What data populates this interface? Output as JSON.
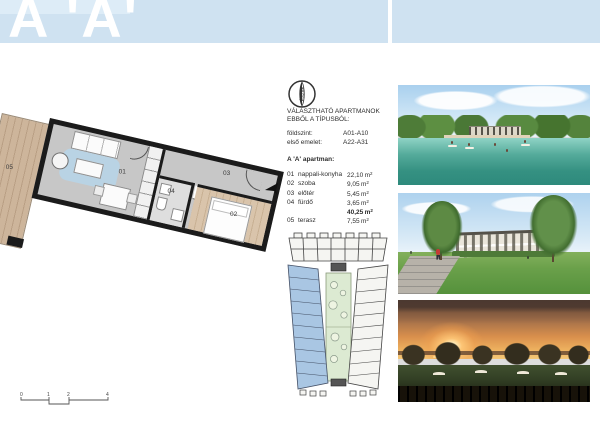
{
  "header": {
    "title": "A 'A'"
  },
  "compass": {
    "label": "Észak"
  },
  "info": {
    "heading_line1": "VÁLASZTHATÓ APARTMANOK",
    "heading_line2": "EBBŐL A TÍPUSBÓL:",
    "floors": [
      {
        "label": "földszint:",
        "value": "A01-A10"
      },
      {
        "label": "első emelet:",
        "value": "A22-A31"
      }
    ],
    "subtitle": "A 'A' apartman:",
    "unit": "m",
    "unit_exp": "2",
    "rooms": [
      {
        "num": "01",
        "label": "nappali-konyha",
        "area": "22,10"
      },
      {
        "num": "02",
        "label": "szoba",
        "area": "9,05"
      },
      {
        "num": "03",
        "label": "előtér",
        "area": "5,45"
      },
      {
        "num": "04",
        "label": "fürdő",
        "area": "3,65"
      }
    ],
    "total_area": "40,25",
    "terrace_row": {
      "num": "05",
      "label": "terasz",
      "area": "7,55"
    }
  },
  "plan": {
    "labels": {
      "living": "01",
      "bedroom": "02",
      "hall": "03",
      "bath": "04",
      "terrace": "05"
    }
  },
  "scalebar": {
    "labels": [
      "0",
      "1",
      "2",
      "4"
    ]
  },
  "colors": {
    "header_blue": "#cfe2f1",
    "plan_wing_blue": "#a9c6e3",
    "courtyard_green": "#dcead2",
    "terrace_wood": "#cdb59b",
    "rug_blue": "#b9d3e4",
    "wall_black": "#1b1b1b"
  }
}
